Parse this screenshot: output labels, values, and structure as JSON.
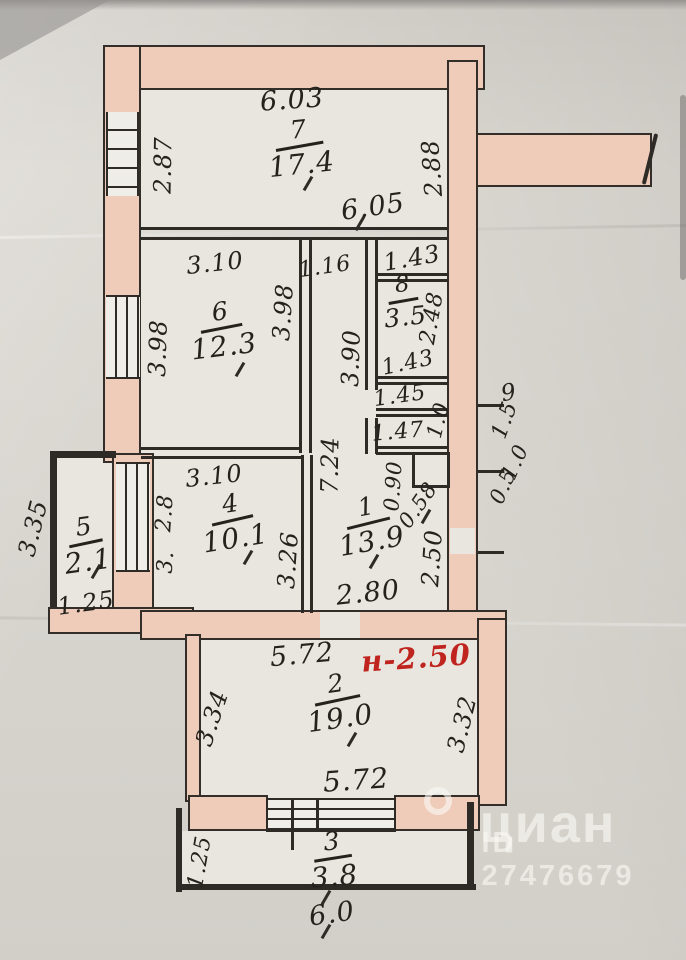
{
  "plan": {
    "rooms": [
      {
        "number": "7",
        "area": "17.4"
      },
      {
        "number": "6",
        "area": "12.3"
      },
      {
        "number": "8",
        "area": "3.5"
      },
      {
        "number": "4",
        "area": "10.1"
      },
      {
        "number": "5",
        "area": "2.1"
      },
      {
        "number": "1",
        "area": "13.9"
      },
      {
        "number": "2",
        "area": "19.0"
      },
      {
        "number": "3",
        "area": "3.8"
      }
    ],
    "dims": {
      "d603": "6.03",
      "d287": "2.87",
      "d288": "2.88",
      "d605": "6.05",
      "d310_6t": "3.10",
      "d116": "1.16",
      "d143_top": "1.43",
      "d398_l": "3.98",
      "d398_r": "3.98",
      "d390": "3.90",
      "d248": "2.48",
      "d143_8": "1.43",
      "d145": "1.45",
      "d147": "1.47",
      "d10_a": "1.0",
      "d9": "9",
      "d15": "1.5",
      "d10_b": "1.0",
      "d05": "0.5",
      "d090": "0.90",
      "d058": "0.58",
      "d724": "7.24",
      "d250": "2.50",
      "d280": "2.80",
      "d310_4t": "3.10",
      "d310_4b": "3.10",
      "d326": "3.26",
      "d28": "2.8",
      "d3dot": "3.",
      "d335": "3.35",
      "d125_5": "1.25",
      "d572_t": "5.72",
      "d334": "3.34",
      "d332": "3.32",
      "d572_b": "5.72",
      "d125_3": "1.25",
      "d60": "6.0"
    },
    "height_note": "н-2.50"
  },
  "watermark": {
    "brand": "циан",
    "id_text": "ID 27476679"
  },
  "colors": {
    "wall_fill": "#efccba",
    "ink": "#25211c",
    "height_note_red": "#c0241e",
    "paper": "#d8d5cf"
  }
}
